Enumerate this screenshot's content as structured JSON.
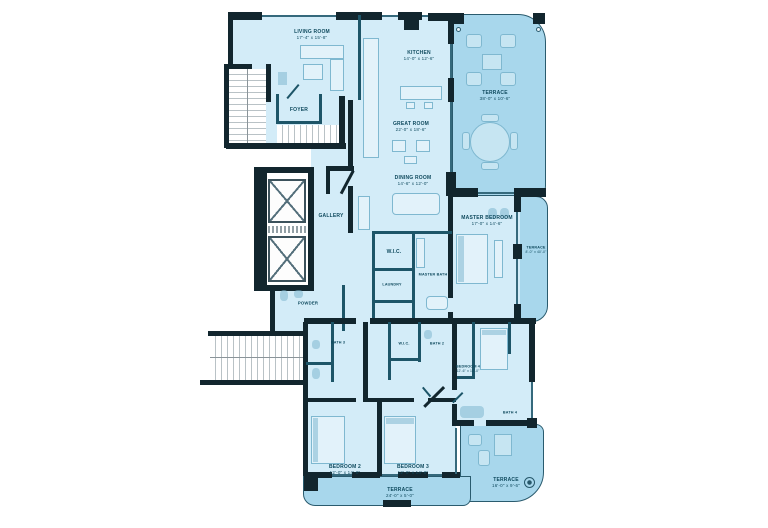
{
  "colors": {
    "interior": "#d3ecf8",
    "terrace": "#a8d7ec",
    "wall": "#12262e",
    "partition": "#1d5568",
    "label_text": "#0f4a5e"
  },
  "rooms": {
    "living": {
      "label": "LIVING ROOM",
      "dims": "17'-4\" x 15'-8\""
    },
    "kitchen": {
      "label": "KITCHEN",
      "dims": "14'-0\" x 12'-6\""
    },
    "great": {
      "label": "GREAT ROOM",
      "dims": "22'-0\" x 18'-6\""
    },
    "dining": {
      "label": "DINING ROOM",
      "dims": "14'-6\" x 12'-0\""
    },
    "foyer": {
      "label": "FOYER"
    },
    "gallery": {
      "label": "GALLERY"
    },
    "powder": {
      "label": "POWDER"
    },
    "wic_master": {
      "label": "W.I.C."
    },
    "laundry": {
      "label": "LAUNDRY"
    },
    "master_bath": {
      "label": "MASTER BATH"
    },
    "master_bedroom": {
      "label": "MASTER BEDROOM",
      "dims": "17'-0\" x 14'-6\""
    },
    "bath3": {
      "label": "BATH 3"
    },
    "wic2": {
      "label": "W.I.C."
    },
    "bath2": {
      "label": "BATH 2"
    },
    "bath4": {
      "label": "BATH 4"
    },
    "bedroom2": {
      "label": "BEDROOM 2",
      "dims": "12'-0\" x 14'-0\""
    },
    "bedroom3": {
      "label": "BEDROOM 3",
      "dims": "12'-0\" x 14'-0\""
    },
    "bedroom4": {
      "label": "BEDROOM 4",
      "dims": "12'-6\" x 13'-0\""
    }
  },
  "terraces": {
    "north": {
      "label": "TERRACE",
      "dims": "38'-0\" x 10'-6\""
    },
    "east": {
      "label": "TERRACE",
      "dims": "8'-0\" x 40'-0\""
    },
    "southeast": {
      "label": "TERRACE",
      "dims": "16'-0\" x 9'-6\""
    },
    "south": {
      "label": "TERRACE",
      "dims": "24'-0\" x 5'-0\""
    }
  }
}
